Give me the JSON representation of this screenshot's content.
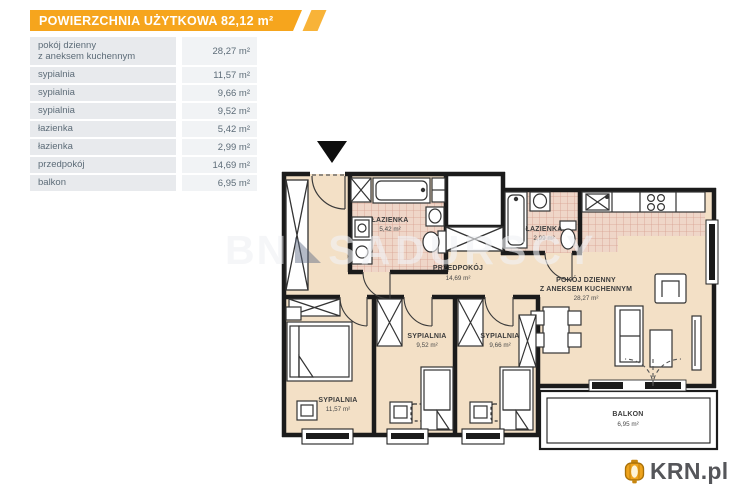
{
  "header": {
    "title": "POWIERZCHNIA UŻYTKOWA 82,12 m²"
  },
  "legend": {
    "rows": [
      {
        "label": "pokój dzienny\nz aneksem kuchennym",
        "value": "28,27 m²"
      },
      {
        "label": "sypialnia",
        "value": "11,57 m²"
      },
      {
        "label": "sypialnia",
        "value": "9,66 m²"
      },
      {
        "label": "sypialnia",
        "value": "9,52 m²"
      },
      {
        "label": "łazienka",
        "value": "5,42 m²"
      },
      {
        "label": "łazienka",
        "value": "2,99 m²"
      },
      {
        "label": "przedpokój",
        "value": "14,69 m²"
      },
      {
        "label": "balkon",
        "value": "6,95 m²"
      }
    ]
  },
  "plan": {
    "rooms": {
      "bath1": {
        "name": "ŁAZIENKA",
        "area": "5,42 m²"
      },
      "bath2": {
        "name": "ŁAZIENKA",
        "area": "2,99 m²"
      },
      "hall": {
        "name": "PRZEDPOKÓJ",
        "area": "14,69 m²"
      },
      "living": {
        "line1": "POKÓJ DZIENNY",
        "line2": "Z ANEKSEM KUCHENNYM",
        "area": "28,27 m²"
      },
      "bed952": {
        "name": "SYPIALNIA",
        "area": "9,52 m²"
      },
      "bed966": {
        "name": "SYPIALNIA",
        "area": "9,66 m²"
      },
      "bed1157": {
        "name": "SYPIALNIA",
        "area": "11,57 m²"
      },
      "balcony": {
        "name": "BALKON",
        "area": "6,95 m²"
      }
    }
  },
  "watermark": {
    "prefix": "BN",
    "text": "SADURSCY"
  },
  "logo": {
    "text": "KRN.pl"
  },
  "colors": {
    "header_orange": "#f6a51d",
    "wall": "#1b1b1b",
    "floor_beige": "#f3e0c6",
    "tile_pink": "#efd6c8",
    "logo_gold": "#eea31d",
    "logo_text": "#55565a"
  }
}
